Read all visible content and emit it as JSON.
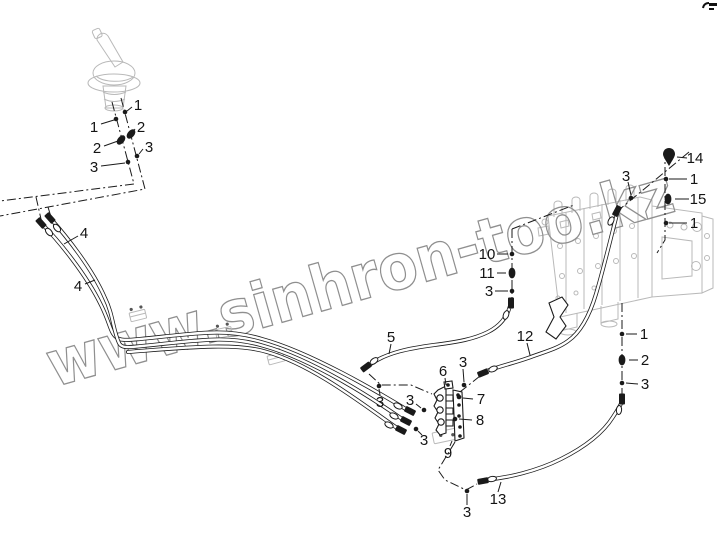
{
  "page": {
    "background": "#ffffff",
    "width": 717,
    "height": 538
  },
  "watermark": {
    "text": "www.sinhron-too.kz",
    "color": "#8f8f8f"
  },
  "diagram": {
    "colors": {
      "line": "#1a1a1a",
      "ghost": "#b9b9b9"
    },
    "callouts": [
      {
        "label": "1",
        "x": 138,
        "y": 105,
        "leader": [
          132,
          107,
          127,
          111
        ],
        "marker": {
          "type": "dot",
          "x": 125,
          "y": 112
        }
      },
      {
        "label": "1",
        "x": 94,
        "y": 127,
        "leader": [
          101,
          124,
          114,
          120
        ],
        "marker": {
          "type": "dot",
          "x": 116,
          "y": 119
        }
      },
      {
        "label": "2",
        "x": 141,
        "y": 127,
        "leader": [
          135,
          129,
          133,
          132
        ],
        "marker": {
          "type": "grommet",
          "x": 131,
          "y": 134,
          "rot": 40
        }
      },
      {
        "label": "2",
        "x": 97,
        "y": 148,
        "leader": [
          104,
          146,
          118,
          141
        ],
        "marker": {
          "type": "grommet",
          "x": 121,
          "y": 140,
          "rot": 40
        }
      },
      {
        "label": "3",
        "x": 149,
        "y": 147,
        "leader": [
          143,
          149,
          139,
          154
        ],
        "marker": {
          "type": "dot",
          "x": 137,
          "y": 156
        }
      },
      {
        "label": "3",
        "x": 94,
        "y": 167,
        "leader": [
          101,
          166,
          125,
          163
        ],
        "marker": {
          "type": "dot",
          "x": 128,
          "y": 162
        }
      },
      {
        "label": "4",
        "x": 84,
        "y": 233,
        "leader": [
          78,
          236,
          64,
          244
        ],
        "marker": {
          "type": "none"
        }
      },
      {
        "label": "4",
        "x": 78,
        "y": 286,
        "leader": [
          85,
          284,
          95,
          280
        ],
        "marker": {
          "type": "none"
        }
      },
      {
        "label": "5",
        "x": 391,
        "y": 337,
        "leader": [
          391,
          344,
          389,
          354
        ],
        "marker": {
          "type": "none"
        }
      },
      {
        "label": "3",
        "x": 380,
        "y": 402,
        "leader": [
          380,
          395,
          379,
          389
        ],
        "marker": {
          "type": "dot",
          "x": 379,
          "y": 386
        }
      },
      {
        "label": "3",
        "x": 410,
        "y": 400,
        "leader": [
          416,
          404,
          421,
          408
        ],
        "marker": {
          "type": "dot",
          "x": 424,
          "y": 410
        }
      },
      {
        "label": "6",
        "x": 443,
        "y": 371,
        "leader": [
          445,
          378,
          446,
          385
        ],
        "marker": {
          "type": "none"
        }
      },
      {
        "label": "3",
        "x": 463,
        "y": 362,
        "leader": [
          463,
          369,
          464,
          382
        ],
        "marker": {
          "type": "dot",
          "x": 464,
          "y": 385
        }
      },
      {
        "label": "7",
        "x": 481,
        "y": 399,
        "leader": [
          473,
          399,
          463,
          398
        ],
        "marker": {
          "type": "dot",
          "x": 459,
          "y": 397
        }
      },
      {
        "label": "8",
        "x": 480,
        "y": 420,
        "leader": [
          472,
          420,
          459,
          419
        ],
        "marker": {
          "type": "dot",
          "x": 455,
          "y": 419
        }
      },
      {
        "label": "9",
        "x": 448,
        "y": 453,
        "leader": [
          450,
          446,
          452,
          441
        ],
        "marker": {
          "type": "none"
        }
      },
      {
        "label": "3",
        "x": 424,
        "y": 440,
        "leader": [
          422,
          435,
          418,
          431
        ],
        "marker": {
          "type": "dot",
          "x": 416,
          "y": 429
        }
      },
      {
        "label": "3",
        "x": 467,
        "y": 512,
        "leader": [
          467,
          505,
          467,
          494
        ],
        "marker": {
          "type": "dot",
          "x": 467,
          "y": 491
        }
      },
      {
        "label": "13",
        "x": 498,
        "y": 499,
        "leader": [
          498,
          492,
          501,
          482
        ],
        "marker": {
          "type": "none"
        }
      },
      {
        "label": "12",
        "x": 525,
        "y": 336,
        "leader": [
          527,
          343,
          530,
          355
        ],
        "marker": {
          "type": "none"
        }
      },
      {
        "label": "10",
        "x": 487,
        "y": 254,
        "leader": [
          497,
          254,
          508,
          254
        ],
        "marker": {
          "type": "dot",
          "x": 512,
          "y": 254
        }
      },
      {
        "label": "11",
        "x": 487,
        "y": 273,
        "leader": [
          497,
          273,
          506,
          273
        ],
        "marker": {
          "type": "grommet",
          "x": 512,
          "y": 273,
          "rot": 0
        }
      },
      {
        "label": "3",
        "x": 489,
        "y": 291,
        "leader": [
          495,
          291,
          508,
          291
        ],
        "marker": {
          "type": "dot",
          "x": 512,
          "y": 291
        }
      },
      {
        "label": "1",
        "x": 644,
        "y": 334,
        "leader": [
          637,
          334,
          626,
          334
        ],
        "marker": {
          "type": "dot",
          "x": 622,
          "y": 334
        }
      },
      {
        "label": "2",
        "x": 645,
        "y": 360,
        "leader": [
          638,
          360,
          629,
          360
        ],
        "marker": {
          "type": "grommet",
          "x": 622,
          "y": 360,
          "rot": 0
        }
      },
      {
        "label": "3",
        "x": 645,
        "y": 384,
        "leader": [
          638,
          384,
          626,
          383
        ],
        "marker": {
          "type": "dot",
          "x": 622,
          "y": 383
        }
      },
      {
        "label": "14",
        "x": 695,
        "y": 158,
        "leader": [
          687,
          158,
          677,
          157
        ],
        "marker": {
          "type": "none"
        }
      },
      {
        "label": "1",
        "x": 694,
        "y": 179,
        "leader": [
          687,
          179,
          669,
          179
        ],
        "marker": {
          "type": "dot",
          "x": 666,
          "y": 179
        }
      },
      {
        "label": "15",
        "x": 698,
        "y": 199,
        "leader": [
          689,
          199,
          675,
          199
        ],
        "marker": {
          "type": "grommet",
          "x": 668,
          "y": 199,
          "rot": 0
        }
      },
      {
        "label": "1",
        "x": 694,
        "y": 223,
        "leader": [
          687,
          223,
          669,
          223
        ],
        "marker": {
          "type": "dot",
          "x": 666,
          "y": 223
        }
      },
      {
        "label": "3",
        "x": 626,
        "y": 176,
        "leader": [
          628,
          182,
          631,
          195
        ],
        "marker": {
          "type": "dot",
          "x": 631,
          "y": 198
        }
      }
    ]
  }
}
